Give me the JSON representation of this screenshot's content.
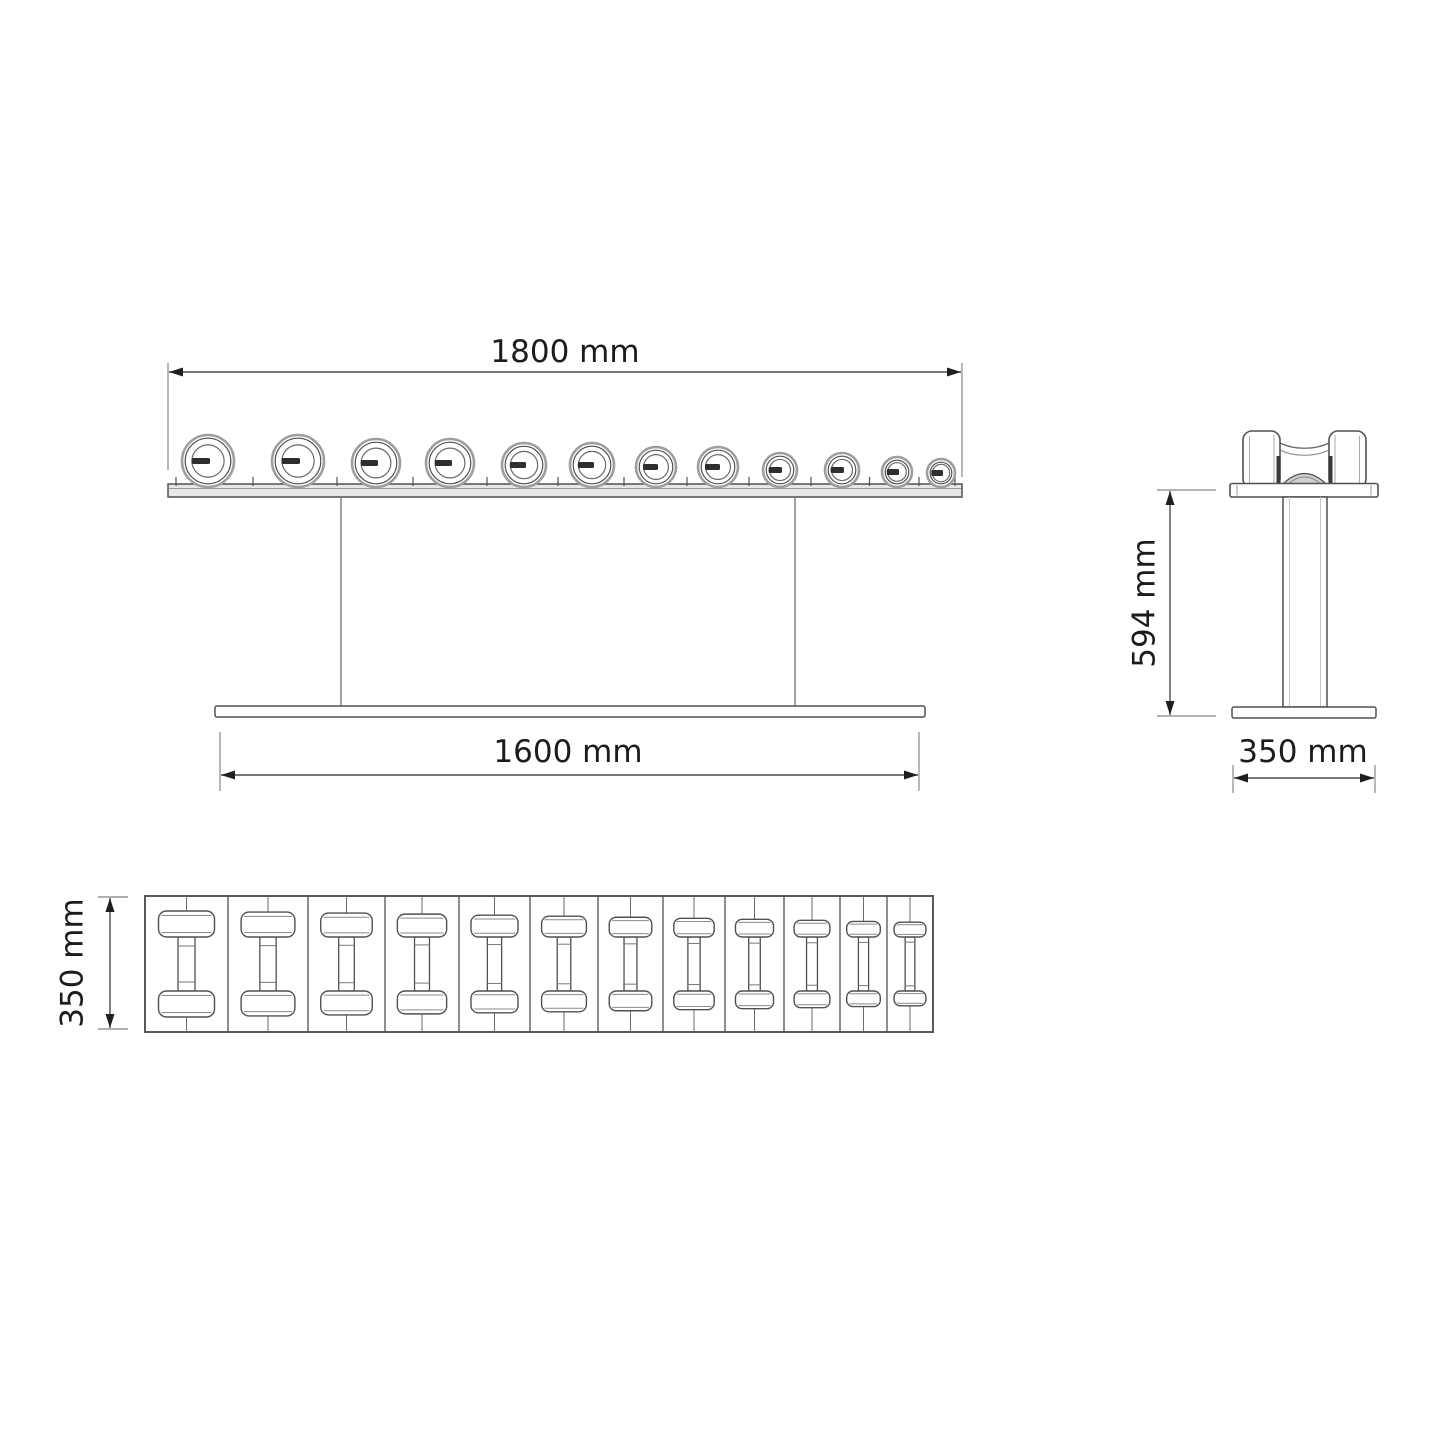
{
  "drawing": {
    "type": "technical-drawing",
    "subject": "dumbbell rack with 12 dumbbells, three orthographic views"
  },
  "labels": {
    "front_width": "1800 mm",
    "base_width": "1600 mm",
    "side_height": "594 mm",
    "side_depth": "350 mm",
    "plan_depth": "350 mm"
  },
  "front_view": {
    "dumbbell_count": 12,
    "dumbbells": [
      {
        "cx": 208,
        "r": 26
      },
      {
        "cx": 298,
        "r": 26
      },
      {
        "cx": 376,
        "r": 24
      },
      {
        "cx": 450,
        "r": 24
      },
      {
        "cx": 524,
        "r": 22
      },
      {
        "cx": 592,
        "r": 22
      },
      {
        "cx": 656,
        "r": 20
      },
      {
        "cx": 718,
        "r": 20
      },
      {
        "cx": 780,
        "r": 17
      },
      {
        "cx": 842,
        "r": 17
      },
      {
        "cx": 897,
        "r": 15
      },
      {
        "cx": 941,
        "r": 14
      }
    ]
  },
  "plan_view": {
    "dumbbell_count": 12,
    "cell_widths": [
      83,
      80,
      77,
      74,
      71,
      68,
      65,
      62,
      59,
      56,
      47,
      46
    ],
    "scales": [
      1,
      0.96,
      0.92,
      0.88,
      0.84,
      0.8,
      0.76,
      0.72,
      0.68,
      0.64,
      0.6,
      0.57
    ]
  },
  "colors": {
    "line": "#515151",
    "line_light": "#9a9a9a",
    "dim_line": "#4a4a4a",
    "arrow": "#1f1f1f",
    "text": "#1c1c1c",
    "shelf_fill": "#e7e7e7",
    "saddle_fill": "#cfcfcf",
    "weight_label": "#2e2e2e",
    "background": "#ffffff"
  }
}
